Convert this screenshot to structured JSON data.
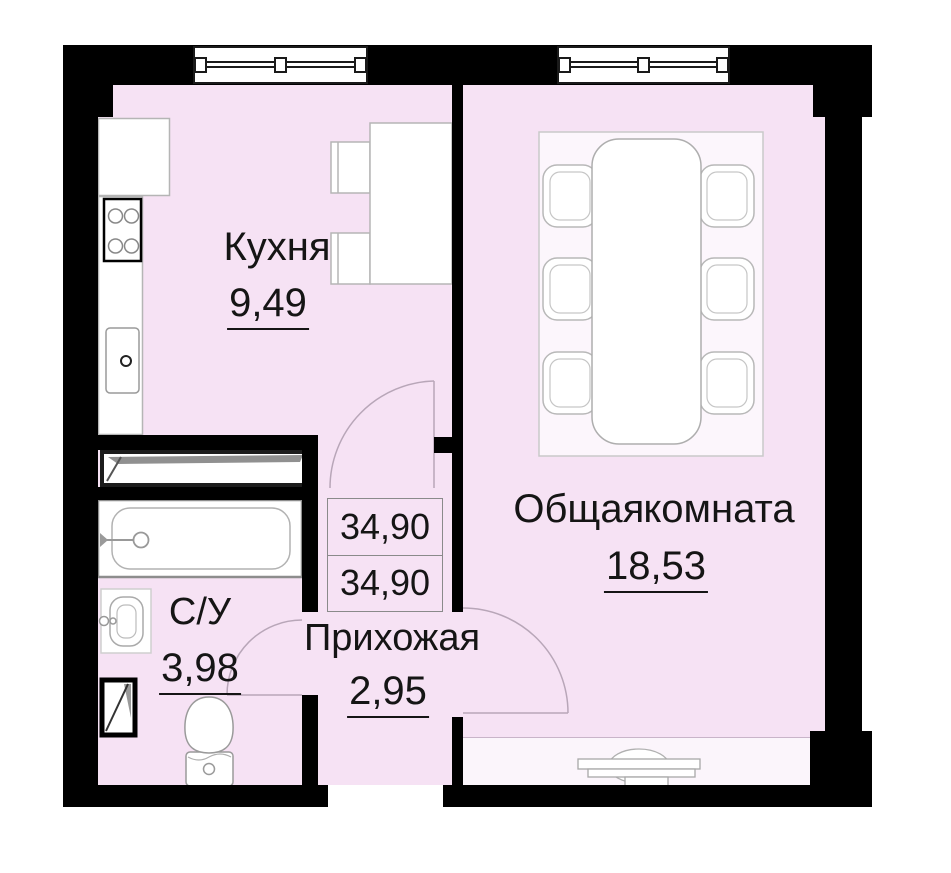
{
  "floorplan": {
    "type": "apartment-floor-plan",
    "rooms": [
      {
        "id": "kitchen",
        "name": "Кухня",
        "area": "9,49"
      },
      {
        "id": "living",
        "name": "Общая комната",
        "area": "18,53"
      },
      {
        "id": "hallway",
        "name": "Прихожая",
        "area": "2,95"
      },
      {
        "id": "bathroom",
        "name": "С/У",
        "area": "3,98"
      }
    ],
    "area_table": {
      "rows": [
        "34,90",
        "34,90"
      ]
    },
    "fixtures": [
      "window",
      "window",
      "kitchen-counter",
      "stove",
      "kitchen-sink",
      "kitchen-table",
      "chairs",
      "dining-table",
      "dining-chairs",
      "rug",
      "wardrobe-shaft",
      "bathtub",
      "washbasin",
      "toilet",
      "vent-shaft",
      "door-arc-kitchen",
      "door-arc-living",
      "door-arc-bathroom",
      "entrance-door-symbol"
    ],
    "colors": {
      "floor": "#f6e2f4",
      "wall": "#000000",
      "fixture_fill": "#ffffff",
      "fixture_outline": "#a8a8a8",
      "door_arc": "#b8a6b8"
    }
  }
}
